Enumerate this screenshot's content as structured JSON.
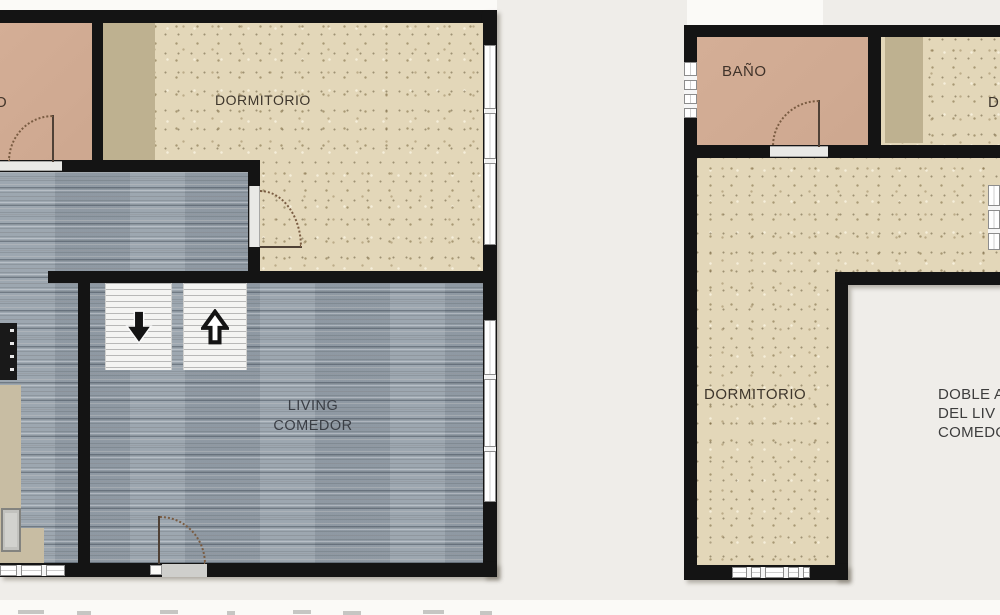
{
  "sheet": {
    "type": "apartment floor plans, two units side by side",
    "colors": {
      "wall": "#141414",
      "wood_floor": "#98a2ac",
      "carpet_floor": "#e3d7b9",
      "bath_floor": "#d1ab93",
      "closet_strip": "#beb190",
      "background": "#efede9",
      "paper_white": "#fbfaf7",
      "window": "#ffffff",
      "door_arc": "#7a5c42"
    }
  },
  "left_plan": {
    "bathroom_label_partial": "O",
    "bedroom_label": "DORMITORIO",
    "living_label_line1": "LIVING",
    "living_label_line2": "COMEDOR",
    "icons": {
      "stairs_down": "stairs-down-arrow",
      "stairs_up": "stairs-up-arrow"
    }
  },
  "right_plan": {
    "bathroom_label": "BAÑO",
    "bedroom_label": "DORMITORIO",
    "second_bedroom_label_partial": "D",
    "double_height_note_line1": "DOBLE A",
    "double_height_note_line2": "DEL LIV",
    "double_height_note_line3": "COMEDO"
  }
}
